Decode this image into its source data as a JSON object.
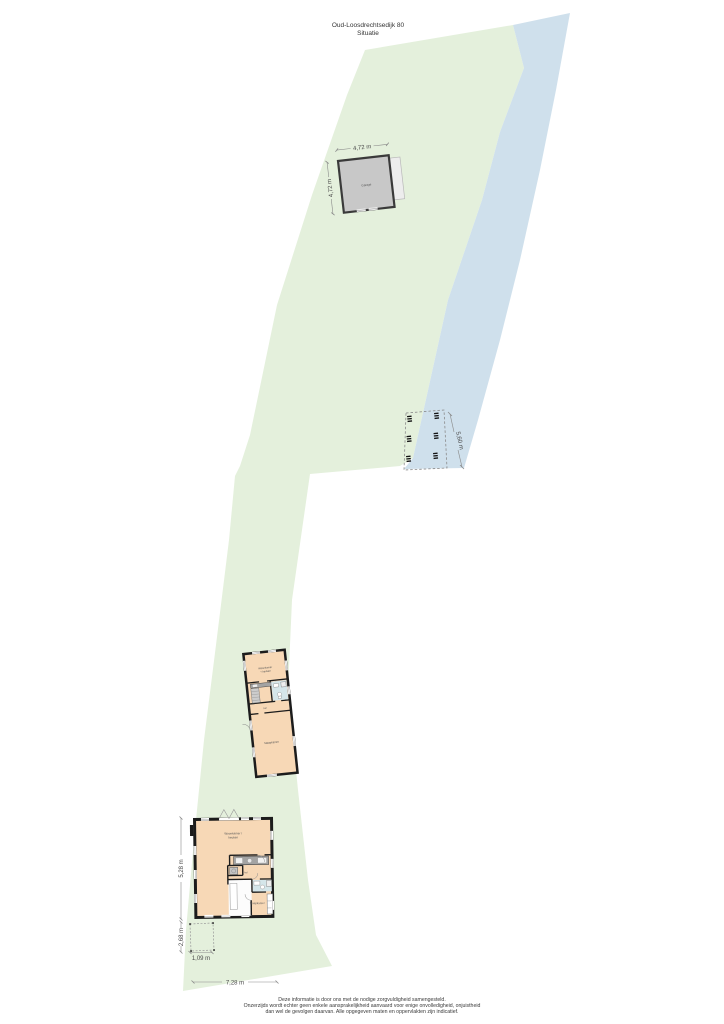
{
  "page": {
    "title": "Oud-Loosdrechtsedijk 80",
    "subtitle": "Situatie",
    "disclaimer": {
      "line1": "Deze informatie is door ons met de nodige zorgvuldigheid samengesteld.",
      "line2": "Onzerzijds wordt echter geen enkele aansprakelijkheid aanvaard voor enige onvolledigheid, onjuistheid",
      "line3": "dan wel de gevolgen daarvan. Alle opgegeven maten en oppervlakten zijn indicatief."
    }
  },
  "colors": {
    "parcel_green": "#e4f0dc",
    "water_blue": "#cfe0ec",
    "room_peach": "#f7d8b6",
    "garage_gray": "#c8c8c8",
    "wall_black": "#1c1c1c",
    "tile_blue": "#d5e6ea"
  },
  "garage": {
    "label": "Garage",
    "dim_width": "4,72 m",
    "dim_depth": "4,72 m"
  },
  "dock": {
    "dim_length": "5,60 m"
  },
  "guest_house": {
    "room_top_line1": "Woonkamer",
    "room_top_line2": "+ keuken",
    "hall_label": "hal",
    "room_bottom_label": "Slaapkamer"
  },
  "main_house": {
    "living_line1": "Woonkamer /",
    "living_line2": "keuken",
    "hall_label": "hal",
    "bedroom_label": "Slaapkamer",
    "dim_side": "5,28 m",
    "dim_terrace_side": "2,68 m",
    "dim_terrace_bottom": "1,09 m",
    "dim_bottom": "7,28 m"
  }
}
